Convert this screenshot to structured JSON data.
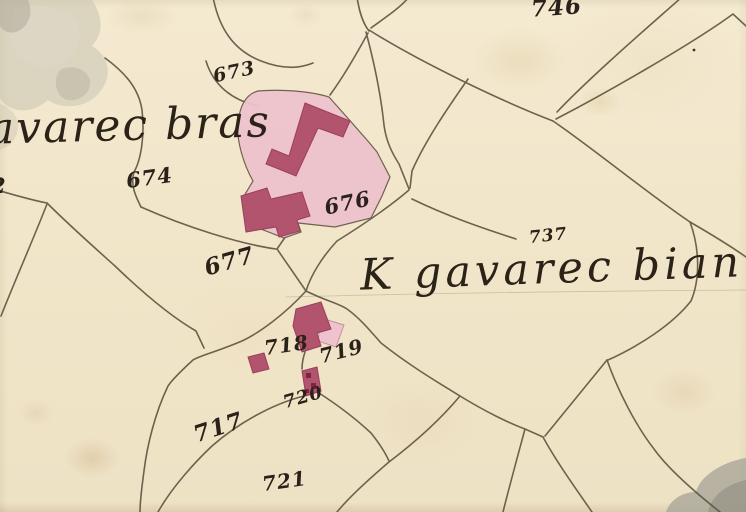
{
  "map": {
    "place_names": {
      "bras": "avarec bras",
      "bian": "K gavarec bian"
    },
    "parcel_numbers": {
      "p2": "2",
      "p673": "673",
      "p674": "674",
      "p676": "676",
      "p677": "677",
      "p717": "717",
      "p718": "718",
      "p719": "719",
      "p720": "720",
      "p721": "721",
      "p737": "737",
      "p746": "746"
    }
  },
  "colors": {
    "paper": "#f2e7cc",
    "ink_line": "#5f5440",
    "ink_text": "#29211a",
    "building_dark": "#b2546e",
    "building_dark_edge": "#9a3f5c",
    "building_dark_spot": "#7c2742",
    "building_light": "#eec3cd",
    "building_light_edge": "#d89aab",
    "wash_gray": "#c7c3b1",
    "wash_gray_light": "#dcd8c8",
    "wash_gray_dark": "#a9a698"
  }
}
